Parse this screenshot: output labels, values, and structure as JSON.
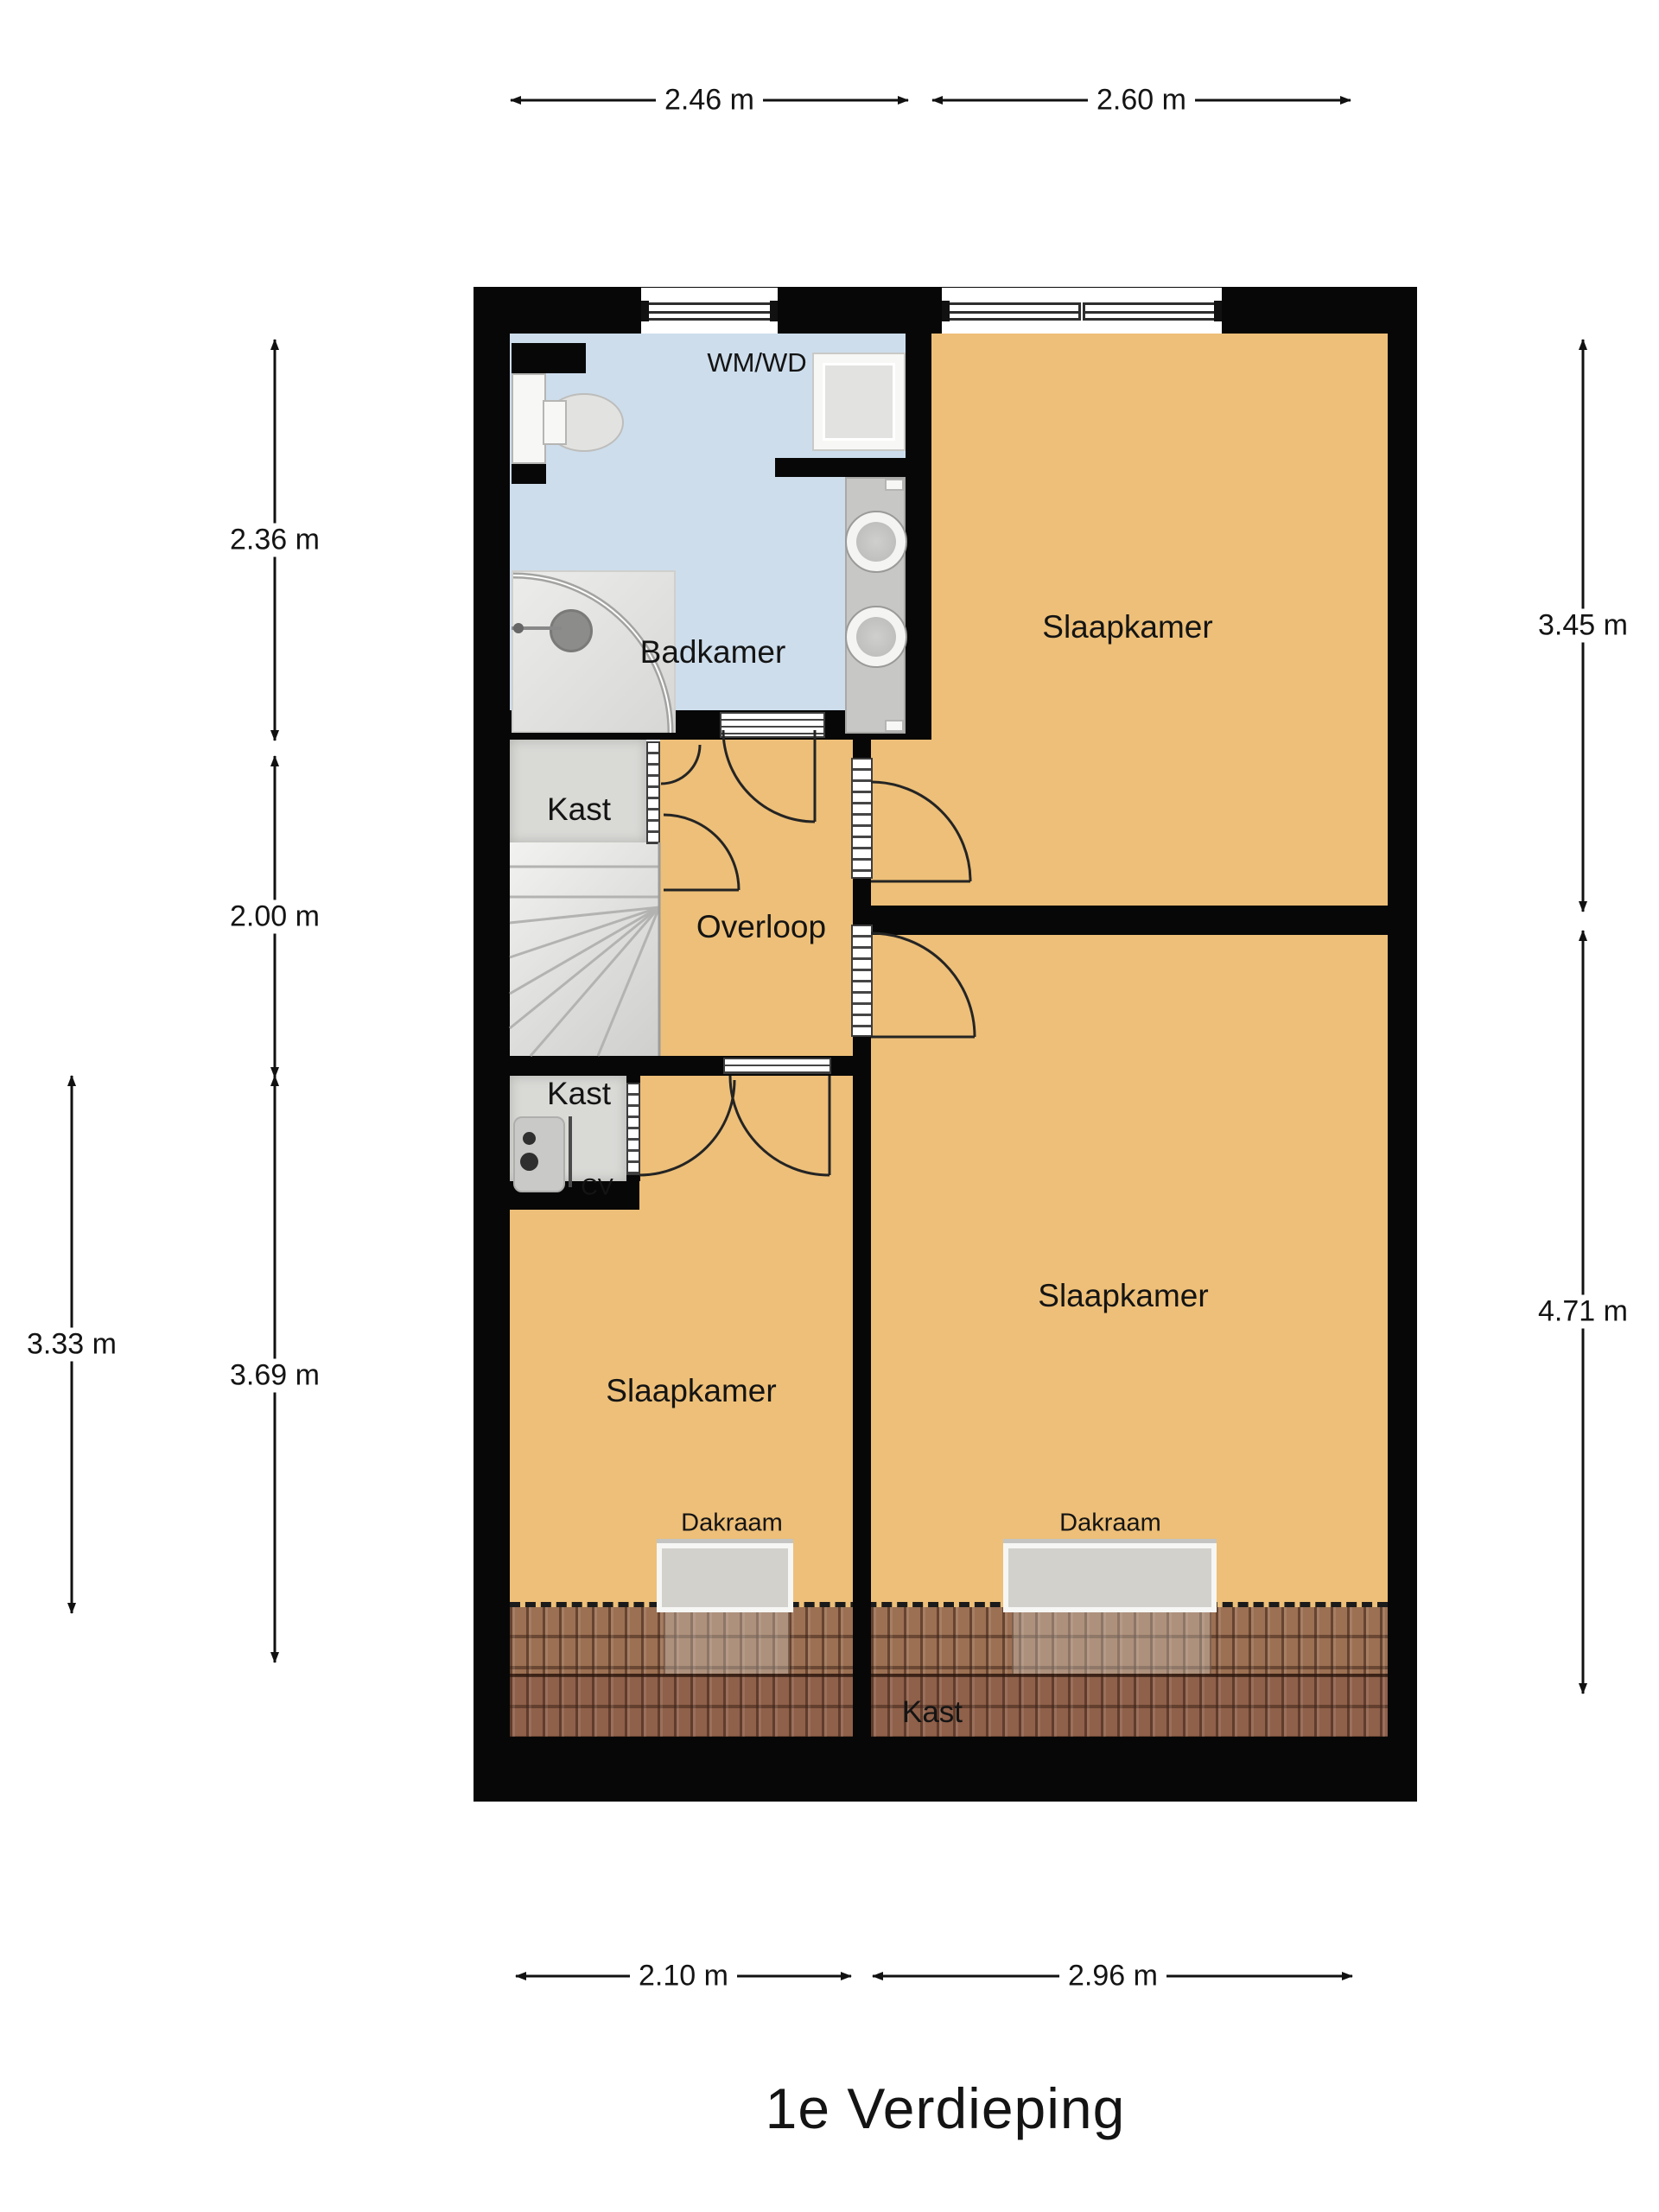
{
  "floorplan": {
    "title": "1e Verdieping",
    "rooms": {
      "badkamer": "Badkamer",
      "slaapkamer_top": "Slaapkamer",
      "slaapkamer_bottom_left": "Slaapkamer",
      "slaapkamer_bottom_right": "Slaapkamer",
      "overloop": "Overloop",
      "kast_top": "Kast",
      "kast_cv": "Kast",
      "kast_roof": "Kast"
    },
    "fixtures": {
      "washer_dryer": "WM/WD",
      "central_heating": "CV",
      "roof_window_left": "Dakraam",
      "roof_window_right": "Dakraam"
    },
    "dimensions": {
      "top": [
        "2.46 m",
        "2.60 m"
      ],
      "left": [
        "2.36 m",
        "2.00 m",
        "3.33 m",
        "3.69 m"
      ],
      "right": [
        "3.45 m",
        "4.71 m"
      ],
      "bottom": [
        "2.10 m",
        "2.96 m"
      ]
    },
    "colors": {
      "wall": "#070707",
      "room_orange": "#edbf78",
      "bathroom_blue": "#cdddec",
      "closet_gray": "#d9d9d6",
      "roof_tile_top": "#9c7053",
      "roof_tile_bottom": "#8f604a"
    }
  }
}
